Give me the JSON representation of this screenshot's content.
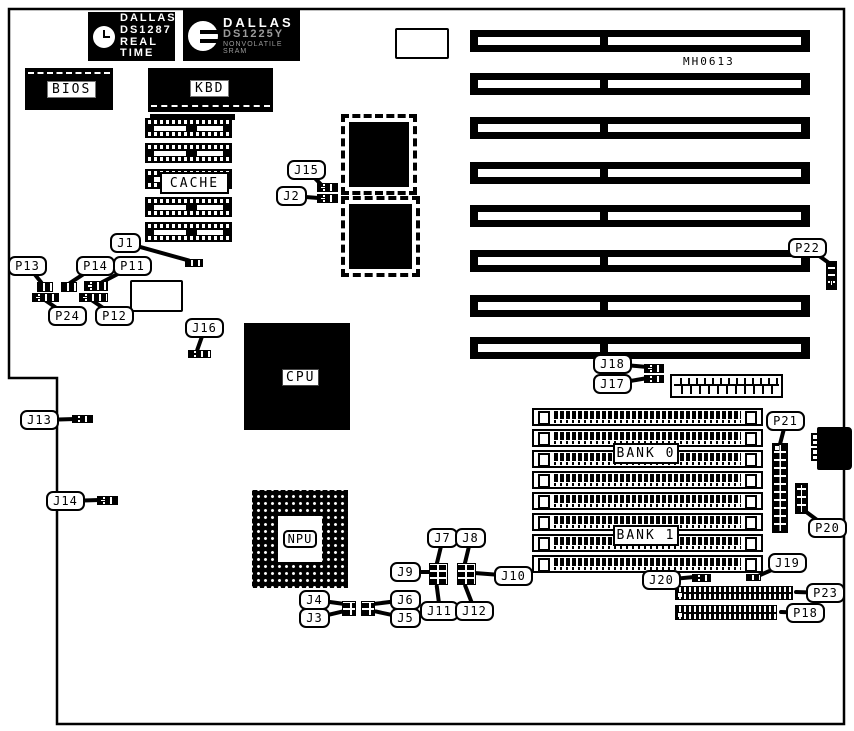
{
  "board": {
    "id_label": "MH0613"
  },
  "colors": {
    "ink": "#000000",
    "paper": "#ffffff",
    "faded_text": "#9b9b9b"
  },
  "brand_chips": {
    "ds1287": {
      "icon": "alarm-clock-icon",
      "lines": [
        "DALLAS",
        "DS1287",
        "REAL TIME"
      ]
    },
    "ds1225": {
      "icon": "dallas-d-logo-icon",
      "lines": [
        "DALLAS",
        "DS1225Y",
        "NONVOLATILE SRAM"
      ]
    }
  },
  "chip_labels": {
    "bios": "BIOS",
    "kbd": "KBD",
    "cache": "CACHE",
    "cpu": "CPU",
    "npu": "NPU",
    "bank0": "BANK 0",
    "bank1": "BANK 1"
  },
  "callouts": [
    {
      "id": "J1",
      "x": 110,
      "y": 233,
      "tx": 190,
      "ty": 261
    },
    {
      "id": "P13",
      "x": 8,
      "y": 256,
      "tx": 42,
      "ty": 284
    },
    {
      "id": "P14",
      "x": 76,
      "y": 256,
      "tx": 68,
      "ty": 284
    },
    {
      "id": "P11",
      "x": 113,
      "y": 256,
      "tx": 100,
      "ty": 283
    },
    {
      "id": "P24",
      "x": 48,
      "y": 306,
      "tx": 40,
      "ty": 297
    },
    {
      "id": "P12",
      "x": 95,
      "y": 306,
      "tx": 88,
      "ty": 298
    },
    {
      "id": "J15",
      "x": 287,
      "y": 160,
      "tx": 322,
      "ty": 186
    },
    {
      "id": "J2",
      "x": 276,
      "y": 186,
      "tx": 318,
      "ty": 198
    },
    {
      "id": "J16",
      "x": 185,
      "y": 318,
      "tx": 196,
      "ty": 352
    },
    {
      "id": "J13",
      "x": 20,
      "y": 410,
      "tx": 76,
      "ty": 419
    },
    {
      "id": "J14",
      "x": 46,
      "y": 491,
      "tx": 100,
      "ty": 500
    },
    {
      "id": "J7",
      "x": 427,
      "y": 528,
      "tx": 436,
      "ty": 565
    },
    {
      "id": "J8",
      "x": 455,
      "y": 528,
      "tx": 464,
      "ty": 565
    },
    {
      "id": "J9",
      "x": 390,
      "y": 562,
      "tx": 431,
      "ty": 572
    },
    {
      "id": "J10",
      "x": 494,
      "y": 566,
      "tx": 474,
      "ty": 573
    },
    {
      "id": "J11",
      "x": 420,
      "y": 601,
      "tx": 436,
      "ty": 584
    },
    {
      "id": "J12",
      "x": 455,
      "y": 601,
      "tx": 464,
      "ty": 584
    },
    {
      "id": "J4",
      "x": 299,
      "y": 590,
      "tx": 344,
      "ty": 604
    },
    {
      "id": "J3",
      "x": 299,
      "y": 608,
      "tx": 344,
      "ty": 611
    },
    {
      "id": "J6",
      "x": 390,
      "y": 590,
      "tx": 373,
      "ty": 604
    },
    {
      "id": "J5",
      "x": 390,
      "y": 608,
      "tx": 373,
      "ty": 611
    },
    {
      "id": "J18",
      "x": 593,
      "y": 354,
      "tx": 647,
      "ty": 367
    },
    {
      "id": "J17",
      "x": 593,
      "y": 374,
      "tx": 647,
      "ty": 378
    },
    {
      "id": "P22",
      "x": 788,
      "y": 238,
      "tx": 830,
      "ty": 264
    },
    {
      "id": "P21",
      "x": 766,
      "y": 411,
      "tx": 779,
      "ty": 446
    },
    {
      "id": "P20",
      "x": 808,
      "y": 518,
      "tx": 803,
      "ty": 510
    },
    {
      "id": "J19",
      "x": 768,
      "y": 553,
      "tx": 755,
      "ty": 577
    },
    {
      "id": "J20",
      "x": 642,
      "y": 570,
      "tx": 694,
      "ty": 577
    },
    {
      "id": "P23",
      "x": 806,
      "y": 583,
      "tx": 794,
      "ty": 592
    },
    {
      "id": "P18",
      "x": 786,
      "y": 603,
      "tx": 779,
      "ty": 612
    }
  ],
  "pinblocks": [
    {
      "id": "J1",
      "kind": "h",
      "x": 185,
      "y": 259,
      "w": 18,
      "h": 8
    },
    {
      "id": "P13",
      "kind": "h",
      "x": 37,
      "y": 282,
      "w": 16,
      "h": 10
    },
    {
      "id": "P14",
      "kind": "h",
      "x": 61,
      "y": 282,
      "w": 16,
      "h": 10
    },
    {
      "id": "P11",
      "kind": "ho",
      "x": 84,
      "y": 281,
      "w": 24,
      "h": 10
    },
    {
      "id": "P24",
      "kind": "ho",
      "x": 32,
      "y": 293,
      "w": 27,
      "h": 9
    },
    {
      "id": "P12",
      "kind": "ho",
      "x": 79,
      "y": 293,
      "w": 29,
      "h": 9
    },
    {
      "id": "J15",
      "kind": "ho",
      "x": 317,
      "y": 183,
      "w": 21,
      "h": 9
    },
    {
      "id": "J2",
      "kind": "ho",
      "x": 317,
      "y": 194,
      "w": 21,
      "h": 9
    },
    {
      "id": "J16",
      "kind": "ho",
      "x": 188,
      "y": 350,
      "w": 23,
      "h": 8
    },
    {
      "id": "J13",
      "kind": "ho",
      "x": 72,
      "y": 415,
      "w": 21,
      "h": 8
    },
    {
      "id": "J14",
      "kind": "ho",
      "x": 97,
      "y": 496,
      "w": 21,
      "h": 9
    },
    {
      "id": "J18",
      "kind": "ho",
      "x": 644,
      "y": 364,
      "w": 20,
      "h": 9
    },
    {
      "id": "J17",
      "kind": "ho",
      "x": 644,
      "y": 375,
      "w": 20,
      "h": 8
    },
    {
      "id": "J19",
      "kind": "h",
      "x": 746,
      "y": 574,
      "w": 15,
      "h": 7
    },
    {
      "id": "J20",
      "kind": "ho",
      "x": 692,
      "y": 574,
      "w": 19,
      "h": 8
    },
    {
      "id": "J7-J9-J11-block",
      "kind": "g",
      "x": 429,
      "y": 563,
      "w": 19,
      "h": 22
    },
    {
      "id": "J8-J10-J12-block",
      "kind": "g",
      "x": 457,
      "y": 563,
      "w": 19,
      "h": 22
    },
    {
      "id": "J3-J4-block",
      "kind": "g",
      "x": 342,
      "y": 601,
      "w": 14,
      "h": 15
    },
    {
      "id": "J5-J6-block",
      "kind": "g",
      "x": 361,
      "y": 601,
      "w": 14,
      "h": 15
    },
    {
      "id": "P22",
      "kind": "v",
      "x": 826,
      "y": 261,
      "w": 11,
      "h": 29
    },
    {
      "id": "P21",
      "kind": "g10",
      "x": 772,
      "y": 443,
      "w": 16,
      "h": 90
    },
    {
      "id": "P20",
      "kind": "g5",
      "x": 795,
      "y": 483,
      "w": 13,
      "h": 31
    },
    {
      "id": "P23",
      "kind": "hdr",
      "x": 675,
      "y": 586,
      "w": 118,
      "h": 14
    },
    {
      "id": "P18",
      "kind": "hdr",
      "x": 675,
      "y": 605,
      "w": 102,
      "h": 15
    },
    {
      "id": "din-aux-1",
      "kind": "mini",
      "x": 811,
      "y": 433,
      "w": 8,
      "h": 13
    },
    {
      "id": "din-aux-2",
      "kind": "mini",
      "x": 811,
      "y": 448,
      "w": 8,
      "h": 13
    }
  ],
  "isa_slots": {
    "x": 470,
    "w": 340,
    "h": 22,
    "ys": [
      30,
      73,
      117,
      162,
      205,
      250,
      295,
      337
    ]
  },
  "simm_rows": {
    "x": 532,
    "w": 231,
    "h": 18,
    "ys": [
      408,
      429,
      450,
      471,
      492,
      513,
      534,
      555
    ]
  },
  "cache_chips": {
    "x": 145,
    "w": 87,
    "h": 20,
    "ys": [
      118,
      143,
      169,
      197,
      222
    ]
  },
  "qfp_chips": [
    {
      "x": 345,
      "y": 118,
      "w": 60,
      "h": 65
    },
    {
      "x": 345,
      "y": 200,
      "w": 63,
      "h": 65
    }
  ],
  "outline_rects": [
    {
      "x": 395,
      "y": 28,
      "w": 50,
      "h": 27
    },
    {
      "x": 130,
      "y": 280,
      "w": 49,
      "h": 28
    }
  ],
  "board_outline_path": "M9 9 H844 V724 H57 V378 H9 Z"
}
